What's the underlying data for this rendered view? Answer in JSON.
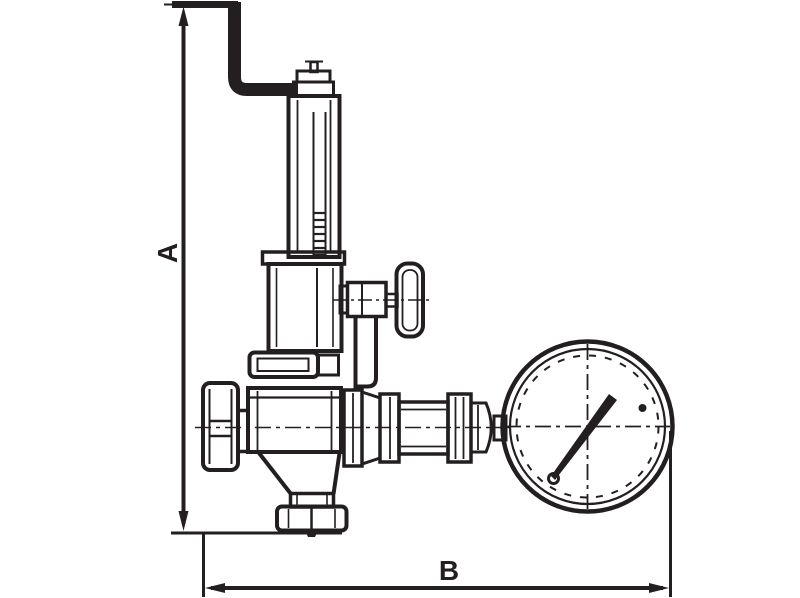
{
  "drawing": {
    "type": "technical-line-drawing",
    "subject": "Pressure reducing valve with bent adjusting lever, side handle and pressure gauge",
    "line_color": "#231f20",
    "background_color": "#ffffff",
    "dimensions": {
      "vertical_label": "A",
      "horizontal_label": "B"
    }
  }
}
